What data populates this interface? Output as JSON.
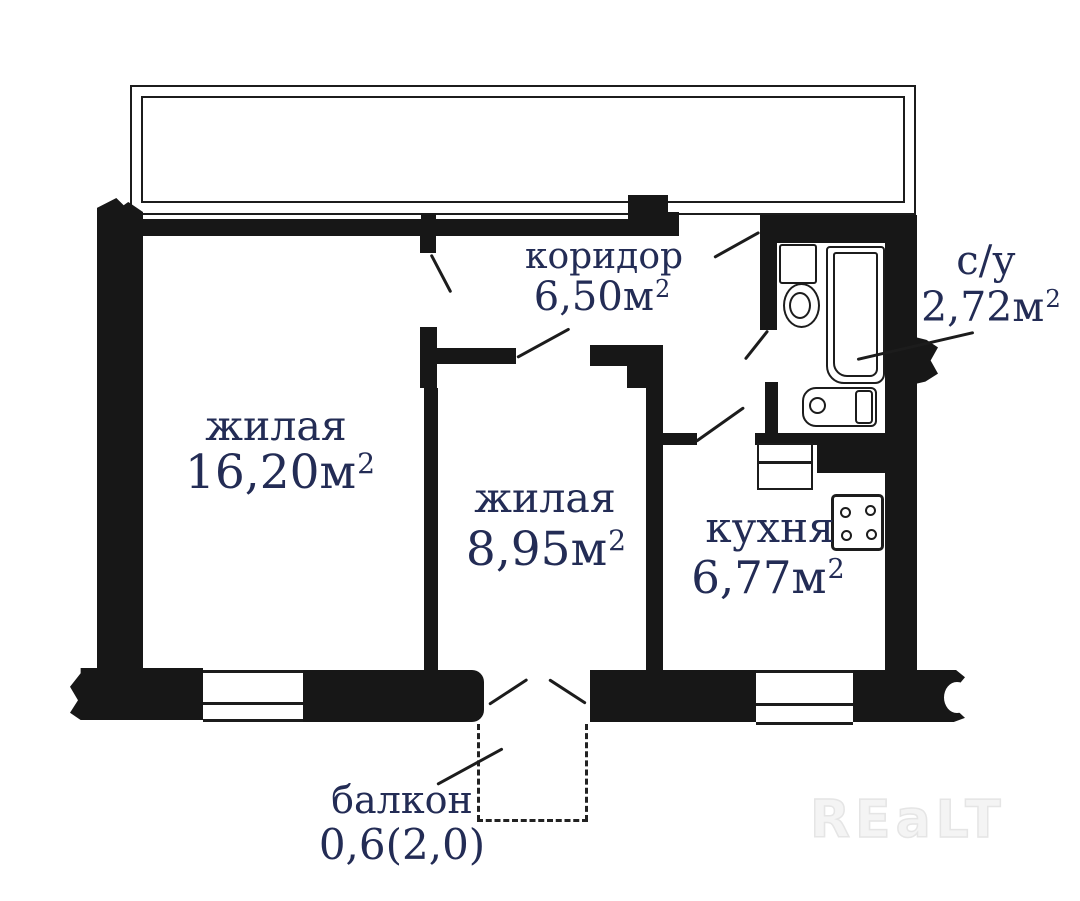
{
  "colors": {
    "wall": "#171717",
    "line": "#1c1c1c",
    "label_text": "#232c55",
    "watermark": "#ececec",
    "background": "#ffffff"
  },
  "watermark": {
    "text": "REaLT"
  },
  "rooms": {
    "living1": {
      "name": "жилая",
      "area": "16,20м",
      "sup": "2"
    },
    "living2": {
      "name": "жилая",
      "area": "8,95м",
      "sup": "2"
    },
    "corridor": {
      "name": "коридор",
      "area": "6,50м",
      "sup": "2"
    },
    "bathroom": {
      "name": "с/у",
      "area": "2,72м",
      "sup": "2"
    },
    "kitchen": {
      "name": "кухня",
      "area": "6,77м",
      "sup": "2"
    },
    "balcony": {
      "name": "балкон",
      "area": "0,6(2,0)",
      "sup": ""
    }
  },
  "fixtures": [
    "toilet",
    "bathtub",
    "washing-machine",
    "kitchen-sink",
    "stove-4-burners",
    "door-swings",
    "windows",
    "balcony-dashed-outline",
    "wall-break-marks"
  ]
}
